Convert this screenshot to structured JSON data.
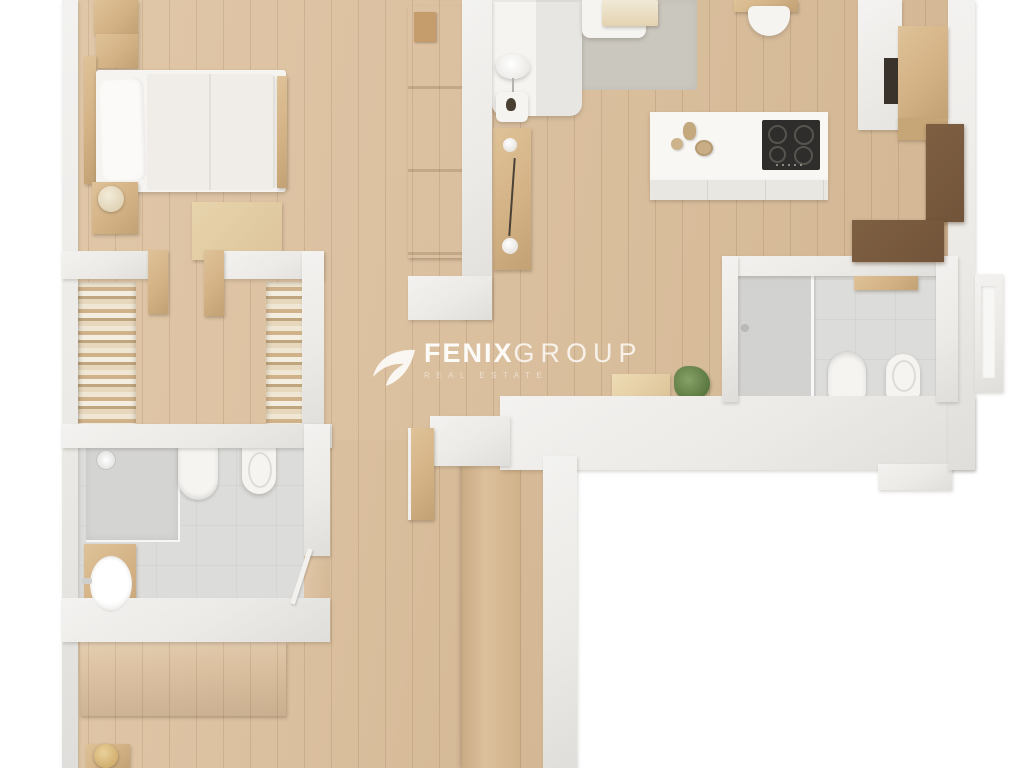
{
  "watermark": {
    "logo_icon": "fenix-swoosh-logo",
    "brand_bold": "FENIX",
    "brand_light": "GROUP",
    "tagline": "REAL ESTATE"
  },
  "palette": {
    "background": "#ffffff",
    "floor_wood": "#ddc19e",
    "floor_wood_dark": "#d2b48c",
    "wall": "#eceae6",
    "wall_shade": "#dfdedb",
    "tile": "#dcdcda",
    "tile_dark": "#d2d2d0",
    "rug": "#cac7bf",
    "furniture_white": "#f5f4f1",
    "furniture_wood": "#d3b285",
    "furniture_wood_dark": "#c2a274",
    "walnut": "#72543a",
    "cooktop": "#2e2d2b",
    "plant": "#6d8a50",
    "lamp_gold": "#c8a25e",
    "watermark": "#ffffff"
  }
}
